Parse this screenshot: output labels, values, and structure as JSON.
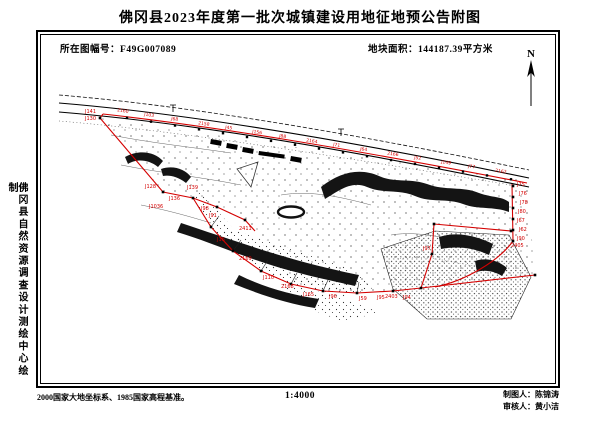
{
  "title": "佛冈县2023年度第一批次城镇建设用地征地预公告附图",
  "header": {
    "sheet_label": "所在图幅号：",
    "sheet_value": "F49G007089",
    "area_label": "地块面积：",
    "area_value": "144187.39平方米"
  },
  "compass": {
    "label": "N"
  },
  "side_caption": "佛冈县自然资源调查设计测绘中心绘制",
  "footer": {
    "datum_note": "2000国家大地坐标系、1985国家高程基准。",
    "scale": "1:4000",
    "drafter_label": "制图人：",
    "drafter_name": "陈锦涛",
    "reviewer_label": "审核人：",
    "reviewer_name": "黄小洁"
  },
  "colors": {
    "boundary_red": "#d40000",
    "ink": "#000000",
    "paper": "#ffffff"
  },
  "map": {
    "point_labels": [
      {
        "t": "J141",
        "x": 44,
        "y": 78
      },
      {
        "t": "J130",
        "x": 44,
        "y": 85
      },
      {
        "t": "J128",
        "x": 104,
        "y": 153
      },
      {
        "t": "J136",
        "x": 128,
        "y": 165
      },
      {
        "t": "J1036",
        "x": 108,
        "y": 173
      },
      {
        "t": "J139",
        "x": 146,
        "y": 154
      },
      {
        "t": "J98",
        "x": 160,
        "y": 175
      },
      {
        "t": "J91",
        "x": 168,
        "y": 182
      },
      {
        "t": "2411",
        "x": 198,
        "y": 195
      },
      {
        "t": "J16",
        "x": 176,
        "y": 206
      },
      {
        "t": "2169",
        "x": 198,
        "y": 225
      },
      {
        "t": "J110",
        "x": 222,
        "y": 244
      },
      {
        "t": "2168",
        "x": 240,
        "y": 253
      },
      {
        "t": "J165",
        "x": 262,
        "y": 261
      },
      {
        "t": "J96",
        "x": 288,
        "y": 263
      },
      {
        "t": "J59",
        "x": 318,
        "y": 265
      },
      {
        "t": "2403",
        "x": 344,
        "y": 263
      },
      {
        "t": "J95",
        "x": 336,
        "y": 264
      },
      {
        "t": "J94",
        "x": 362,
        "y": 264
      },
      {
        "t": "J97",
        "x": 382,
        "y": 215
      },
      {
        "t": "J75",
        "x": 476,
        "y": 151
      },
      {
        "t": "J76",
        "x": 478,
        "y": 160
      },
      {
        "t": "J78",
        "x": 479,
        "y": 169
      },
      {
        "t": "J80",
        "x": 477,
        "y": 178
      },
      {
        "t": "J67",
        "x": 476,
        "y": 187
      },
      {
        "t": "J62",
        "x": 478,
        "y": 196
      },
      {
        "t": "J90",
        "x": 476,
        "y": 205
      },
      {
        "t": "2405",
        "x": 470,
        "y": 212
      }
    ],
    "road_labels": [
      "2160",
      "J103",
      "J68",
      "2158",
      "J45",
      "J156",
      "J88",
      "2164",
      "J71",
      "J64",
      "2166",
      "J52",
      "J149",
      "J77",
      "2162"
    ]
  }
}
